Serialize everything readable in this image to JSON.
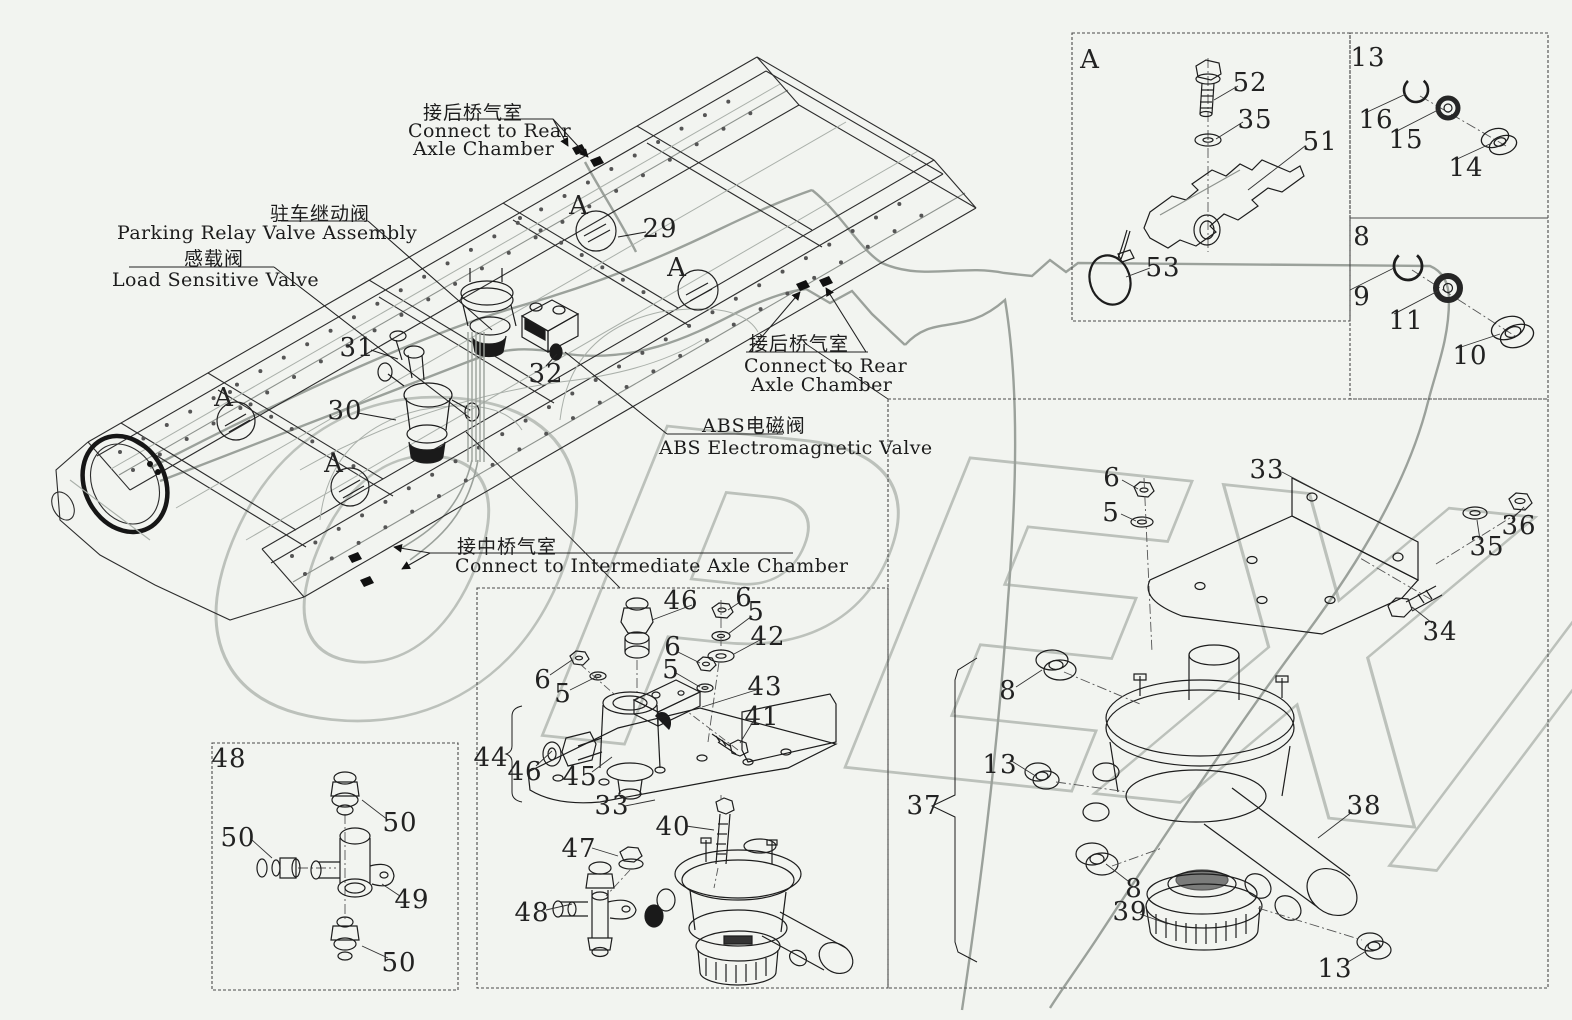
{
  "watermark": {
    "text": "OPEX/",
    "color": "#b7bcb6"
  },
  "colors": {
    "background": "#f2f4f0",
    "line": "#2c2c2c",
    "tube": "#9ba19b",
    "leader": "#333333"
  },
  "labels": {
    "rear_top": {
      "zh": "接后桥气室",
      "en1": "Connect to Rear",
      "en2": "Axle Chamber"
    },
    "parking": {
      "zh": "驻车继动阀",
      "en": "Parking Relay Valve Assembly"
    },
    "load": {
      "zh": "感载阀",
      "en": "Load Sensitive Valve"
    },
    "rear_side": {
      "zh": "接后桥气室",
      "en1": "Connect to Rear",
      "en2": "Axle Chamber"
    },
    "abs": {
      "zh": "ABS电磁阀",
      "en": "ABS Electromagnetic Valve"
    },
    "intermediate": {
      "zh": "接中桥气室",
      "en": "Connect to Intermediate Axle Chamber"
    }
  },
  "callouts": [
    {
      "t": "A",
      "x": 579,
      "y": 206
    },
    {
      "t": "29",
      "x": 660,
      "y": 229
    },
    {
      "t": "A",
      "x": 677,
      "y": 268
    },
    {
      "t": "31",
      "x": 357,
      "y": 348
    },
    {
      "t": "32",
      "x": 546,
      "y": 374
    },
    {
      "t": "30",
      "x": 345,
      "y": 411
    },
    {
      "t": "A",
      "x": 224,
      "y": 398
    },
    {
      "t": "A",
      "x": 334,
      "y": 464
    },
    {
      "t": "A",
      "x": 1090,
      "y": 60
    },
    {
      "t": "52",
      "x": 1250,
      "y": 83
    },
    {
      "t": "35",
      "x": 1255,
      "y": 120
    },
    {
      "t": "51",
      "x": 1320,
      "y": 142
    },
    {
      "t": "53",
      "x": 1163,
      "y": 268
    },
    {
      "t": "13",
      "x": 1368,
      "y": 58
    },
    {
      "t": "16",
      "x": 1376,
      "y": 120
    },
    {
      "t": "15",
      "x": 1406,
      "y": 140
    },
    {
      "t": "14",
      "x": 1466,
      "y": 168
    },
    {
      "t": "8",
      "x": 1362,
      "y": 237
    },
    {
      "t": "9",
      "x": 1362,
      "y": 297
    },
    {
      "t": "11",
      "x": 1406,
      "y": 321
    },
    {
      "t": "10",
      "x": 1470,
      "y": 356
    },
    {
      "t": "6",
      "x": 1112,
      "y": 478
    },
    {
      "t": "5",
      "x": 1111,
      "y": 513
    },
    {
      "t": "33",
      "x": 1267,
      "y": 470
    },
    {
      "t": "36",
      "x": 1519,
      "y": 526
    },
    {
      "t": "35",
      "x": 1487,
      "y": 547
    },
    {
      "t": "34",
      "x": 1440,
      "y": 632
    },
    {
      "t": "8",
      "x": 1008,
      "y": 691
    },
    {
      "t": "13",
      "x": 1000,
      "y": 765
    },
    {
      "t": "37",
      "x": 924,
      "y": 806
    },
    {
      "t": "38",
      "x": 1364,
      "y": 806
    },
    {
      "t": "8",
      "x": 1134,
      "y": 889
    },
    {
      "t": "39",
      "x": 1130,
      "y": 912
    },
    {
      "t": "13",
      "x": 1335,
      "y": 969
    },
    {
      "t": "46",
      "x": 681,
      "y": 601
    },
    {
      "t": "6",
      "x": 744,
      "y": 598
    },
    {
      "t": "5",
      "x": 756,
      "y": 612
    },
    {
      "t": "42",
      "x": 768,
      "y": 637
    },
    {
      "t": "6",
      "x": 673,
      "y": 647
    },
    {
      "t": "5",
      "x": 671,
      "y": 670
    },
    {
      "t": "43",
      "x": 765,
      "y": 687
    },
    {
      "t": "41",
      "x": 762,
      "y": 717
    },
    {
      "t": "6",
      "x": 543,
      "y": 680
    },
    {
      "t": "5",
      "x": 563,
      "y": 694
    },
    {
      "t": "44",
      "x": 491,
      "y": 758
    },
    {
      "t": "46",
      "x": 525,
      "y": 772
    },
    {
      "t": "45",
      "x": 580,
      "y": 777
    },
    {
      "t": "33",
      "x": 612,
      "y": 806
    },
    {
      "t": "40",
      "x": 673,
      "y": 827
    },
    {
      "t": "47",
      "x": 579,
      "y": 849
    },
    {
      "t": "48",
      "x": 532,
      "y": 913
    },
    {
      "t": "48",
      "x": 229,
      "y": 759
    },
    {
      "t": "50",
      "x": 400,
      "y": 823
    },
    {
      "t": "50",
      "x": 238,
      "y": 838
    },
    {
      "t": "49",
      "x": 412,
      "y": 900
    },
    {
      "t": "50",
      "x": 399,
      "y": 963
    }
  ]
}
